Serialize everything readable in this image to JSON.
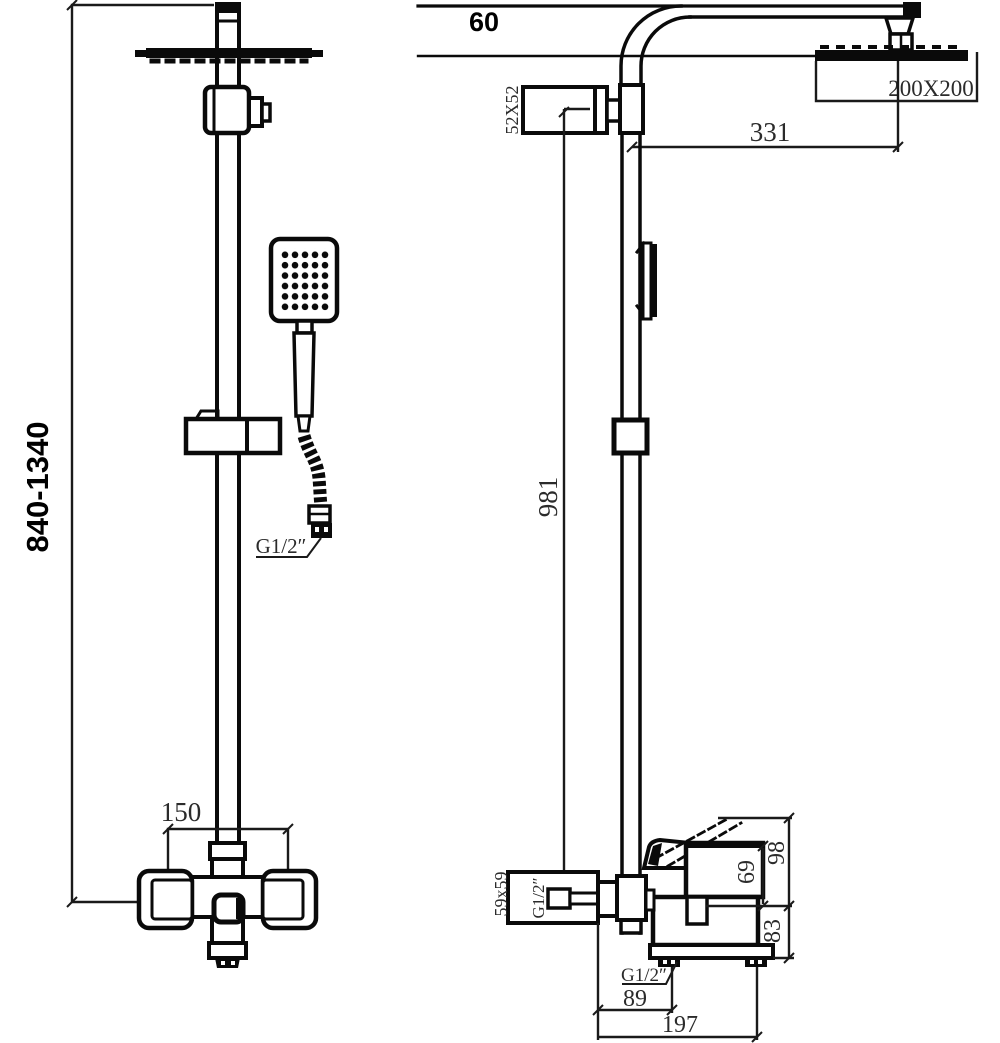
{
  "front_view": {
    "height_range": "840-1340",
    "mixer_spacing": "150",
    "hose_thread": "G1/2″"
  },
  "side_view": {
    "ceiling_offset": "60",
    "head_size": "200X200",
    "arm_reach": "331",
    "holder_size": "52X52",
    "riser_length": "981",
    "inlet_flange_size": "59x59",
    "inlet_thread": "G1/2″",
    "lever_to_spout": "98",
    "body_to_spout": "69",
    "spout_to_base": "83",
    "outlet_thread": "G1/2″",
    "outlet_offset": "89",
    "total_depth": "197"
  }
}
